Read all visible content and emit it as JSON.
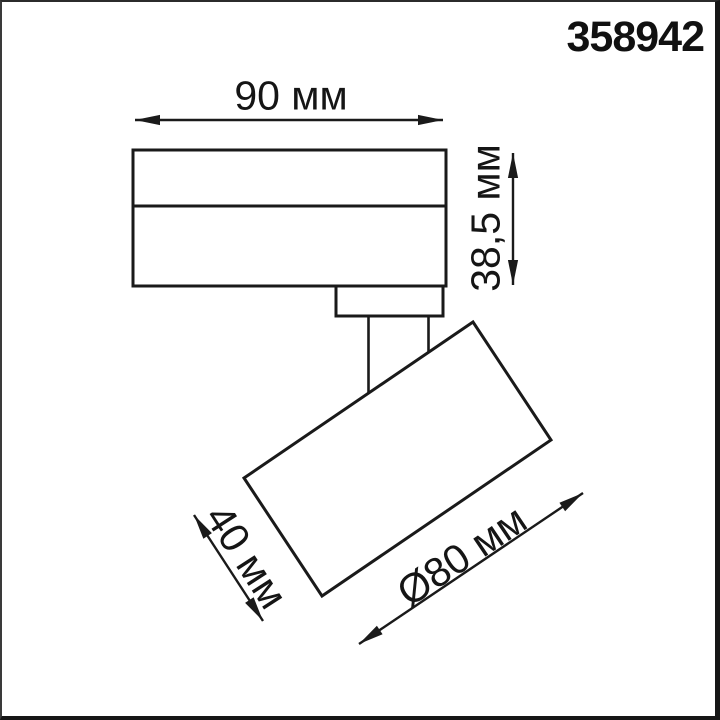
{
  "product": {
    "code": "358942"
  },
  "dimensions": {
    "body_width": "90 мм",
    "body_height": "38,5 мм",
    "head_depth": "40 мм",
    "head_diameter": "Ø80 мм"
  },
  "colors": {
    "line": "#1a1a1a",
    "background": "#ffffff",
    "text": "#151515"
  }
}
